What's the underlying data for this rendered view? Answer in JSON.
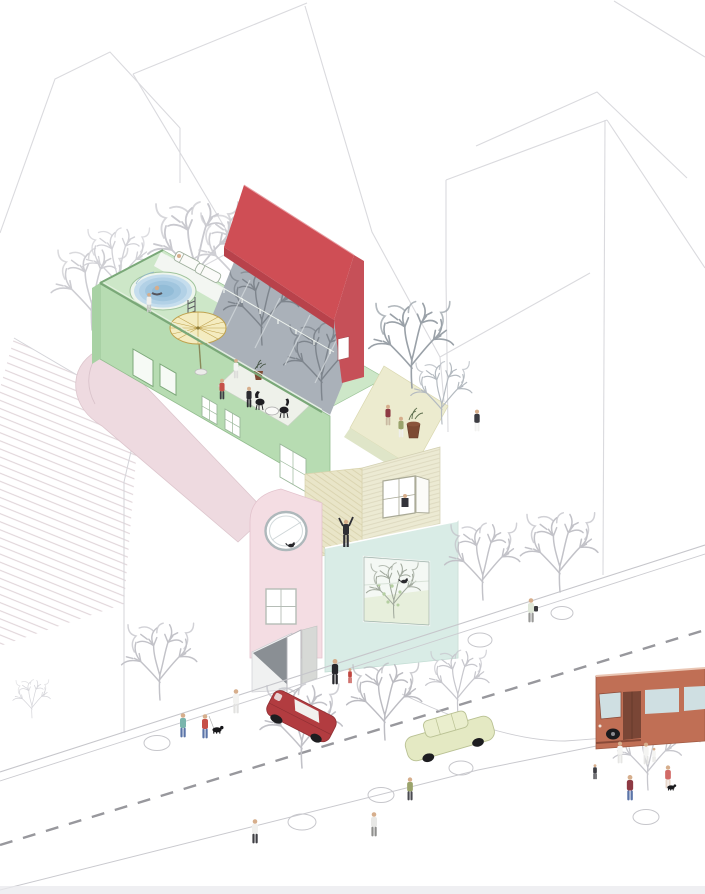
{
  "palette": {
    "canvas": "#ffffff",
    "line_light": "#dadade",
    "line_mid": "#c6c6cb",
    "tree": "#c7c7cd",
    "tree_dark": "#9aa1a8",
    "deck_green": "#cde7c8",
    "wall_green": "#b7dcb2",
    "wall_green_dark": "#a8d2a4",
    "green_edge": "#7aa878",
    "pool_rim": "#eef5ed",
    "pool_1": "#c5dded",
    "pool_2": "#b2d1e6",
    "pool_3": "#a0c5de",
    "pool_4": "#92bcd7",
    "parasol": "#f4ecc0",
    "parasol_edge": "#bfa14c",
    "red_roof": "#cf4e55",
    "red_roof_dark": "#b8424b",
    "red_gable": "#c65058",
    "gray_wall": "#aab1b9",
    "gray_wall_light": "#c9ced4",
    "pink_wall": "#f4dde3",
    "pink_curve": "#eedae0",
    "yellow_terrace": "#ecebcf",
    "siding": "#ecead3",
    "climb": "#e9e5c8",
    "mint": "#d9ece6",
    "interior_floor": "#e7efdc",
    "window_white": "#ffffff",
    "frame": "#9fb3ab",
    "street_dash": "#98989d",
    "red_car": "#b23c40",
    "yellow_car": "#e4e9c3",
    "bus": "#c06f55",
    "bus_window": "#cfdfe2",
    "bus_door": "#7a4636",
    "dark": "#232327",
    "skin": "#d6ae8c",
    "denim": "#5b74a8"
  },
  "scene": {
    "type": "axonometric architectural illustration",
    "setting": "colourful infill house on a street corner between white background building volumes",
    "main_building": {
      "roof_terrace": [
        "circular plunge pool",
        "two loungers",
        "yellow parasol",
        "pool ladder",
        "sunken dining terrace with table and two chairs",
        "planters"
      ],
      "elements": [
        "red pitched roof with small white opening",
        "tree-shadowed grey party wall",
        "green terrace volume with small windows",
        "pink barrel-vaulted wing with porthole window and four-pane window",
        "textured climbing wall with climber",
        "clapboard wall with shuttered window",
        "mint volume with large picture window, indoor tree and cat",
        "entrance ramp with open door"
      ]
    },
    "street": {
      "vehicles": [
        "red saloon car",
        "pale yellow-green car",
        "terracotta bus"
      ],
      "people_count": 26,
      "dogs": 2,
      "cats": 2,
      "street_trees": 8,
      "tree_pits": 7,
      "markings": "dashed centre line between double kerb lines"
    }
  }
}
